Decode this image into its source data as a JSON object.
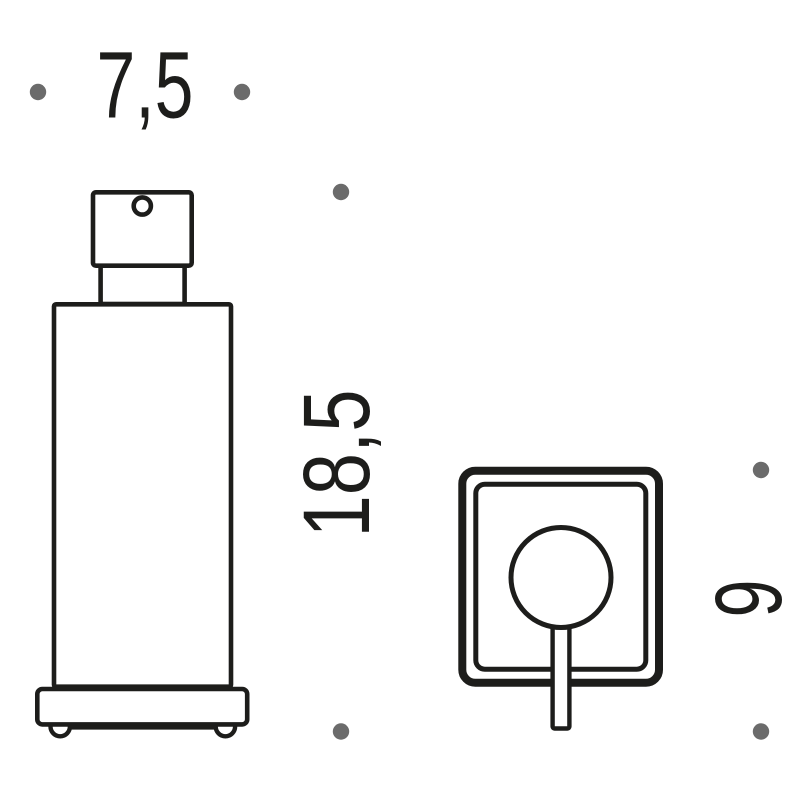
{
  "labels": {
    "width": "7,5",
    "height": "18,5",
    "depth": "9"
  },
  "colors": {
    "line": "#1d1d1b",
    "marker_dot": "#6b6b6b",
    "background": "#ffffff"
  }
}
